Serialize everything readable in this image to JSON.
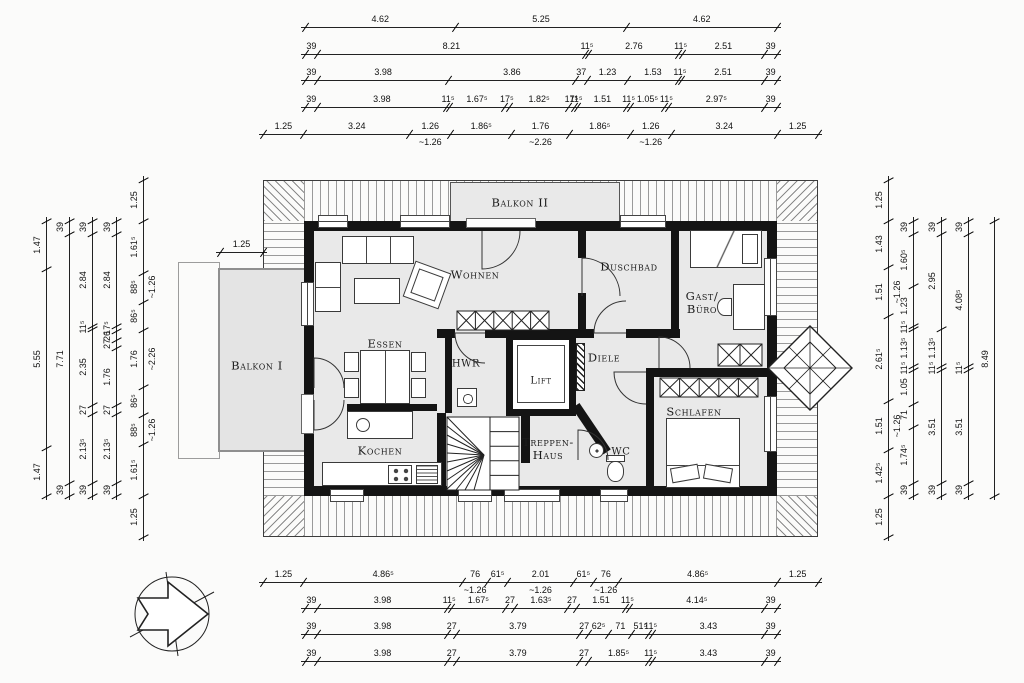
{
  "rooms": {
    "balkon2": "Balkon II",
    "wohnen": "Wohnen",
    "duschbad": "Duschbad",
    "gast_line1": "Gast/",
    "gast_line2": "Büro",
    "essen": "Essen",
    "hwr": "HWR",
    "lift": "Lift",
    "diele": "Diele",
    "balkon1": "Balkon I",
    "schlafen": "Schlafen",
    "kochen": "Kochen",
    "treppen_line1": "Treppen-",
    "treppen_line2": "Haus",
    "wc": "WC"
  },
  "colors": {
    "wall": "#141414",
    "floor": "#e9e9e9",
    "balcony": "#e4e4e4",
    "dimline": "#222222"
  },
  "dims": {
    "t1": [
      {
        "l": "4.62",
        "w": 4.62
      },
      {
        "l": "5.25",
        "w": 5.25
      },
      {
        "l": "4.62",
        "w": 4.62
      }
    ],
    "t2": [
      {
        "l": "39",
        "w": 0.39
      },
      {
        "l": "8.21",
        "w": 8.21
      },
      {
        "l": "11⁵",
        "w": 0.115
      },
      {
        "l": "2.76",
        "w": 2.76
      },
      {
        "l": "11⁵",
        "w": 0.115
      },
      {
        "l": "2.51",
        "w": 2.51
      },
      {
        "l": "39",
        "w": 0.39
      }
    ],
    "t3": [
      {
        "l": "39",
        "w": 0.39
      },
      {
        "l": "3.98",
        "w": 3.98
      },
      {
        "l": "3.86",
        "w": 3.86
      },
      {
        "l": "37",
        "w": 0.37
      },
      {
        "l": "1.23",
        "w": 1.23
      },
      {
        "l": "1.53",
        "w": 1.53
      },
      {
        "l": "11⁵",
        "w": 0.115
      },
      {
        "l": "2.51",
        "w": 2.51
      },
      {
        "l": "39",
        "w": 0.39
      }
    ],
    "t4": [
      {
        "l": "39",
        "w": 0.39
      },
      {
        "l": "3.98",
        "w": 3.98
      },
      {
        "l": "11⁵",
        "w": 0.115
      },
      {
        "l": "1.67⁵",
        "w": 1.675
      },
      {
        "l": "17⁵",
        "w": 0.175
      },
      {
        "l": "1.82⁵",
        "w": 1.825
      },
      {
        "l": "17⁵",
        "w": 0.175
      },
      {
        "l": "11⁵",
        "w": 0.115
      },
      {
        "l": "1.51",
        "w": 1.51
      },
      {
        "l": "11⁵",
        "w": 0.115
      },
      {
        "l": "1.05⁵",
        "w": 1.055
      },
      {
        "l": "11⁵",
        "w": 0.115
      },
      {
        "l": "2.97⁵",
        "w": 2.975
      },
      {
        "l": "39",
        "w": 0.39
      }
    ],
    "t5": [
      {
        "l": "1.25",
        "w": 1.25
      },
      {
        "l": "3.24",
        "w": 3.24
      },
      {
        "l": "1.26",
        "w": 1.26,
        "s": "~1.26"
      },
      {
        "l": "1.86⁵",
        "w": 1.865
      },
      {
        "l": "1.76",
        "w": 1.76,
        "s": "~2.26"
      },
      {
        "l": "1.86⁵",
        "w": 1.865
      },
      {
        "l": "1.26",
        "w": 1.26,
        "s": "~1.26"
      },
      {
        "l": "3.24",
        "w": 3.24
      },
      {
        "l": "1.25",
        "w": 1.25
      }
    ],
    "b1": [
      {
        "l": "1.25",
        "w": 1.25
      },
      {
        "l": "4.86⁵",
        "w": 4.865
      },
      {
        "l": "76",
        "w": 0.76,
        "s": "~1.26"
      },
      {
        "l": "61⁵",
        "w": 0.615
      },
      {
        "l": "2.01",
        "w": 2.01,
        "s": "~1.26"
      },
      {
        "l": "61⁵",
        "w": 0.615
      },
      {
        "l": "76",
        "w": 0.76,
        "s": "~1.26"
      },
      {
        "l": "4.86⁵",
        "w": 4.865
      },
      {
        "l": "1.25",
        "w": 1.25
      }
    ],
    "b2": [
      {
        "l": "39",
        "w": 0.39
      },
      {
        "l": "3.98",
        "w": 3.98
      },
      {
        "l": "11⁵",
        "w": 0.115
      },
      {
        "l": "1.67⁵",
        "w": 1.675
      },
      {
        "l": "27",
        "w": 0.27
      },
      {
        "l": "1.63⁵",
        "w": 1.635
      },
      {
        "l": "27",
        "w": 0.27
      },
      {
        "l": "1.51",
        "w": 1.51
      },
      {
        "l": "11⁵",
        "w": 0.115
      },
      {
        "l": "4.14⁵",
        "w": 4.145
      },
      {
        "l": "39",
        "w": 0.39
      }
    ],
    "b3": [
      {
        "l": "39",
        "w": 0.39
      },
      {
        "l": "3.98",
        "w": 3.98
      },
      {
        "l": "27",
        "w": 0.27
      },
      {
        "l": "3.79",
        "w": 3.79
      },
      {
        "l": "27",
        "w": 0.27
      },
      {
        "l": "62⁵",
        "w": 0.625
      },
      {
        "l": "71",
        "w": 0.71
      },
      {
        "l": "51⁵",
        "w": 0.515
      },
      {
        "l": "11⁵",
        "w": 0.115
      },
      {
        "l": "3.43",
        "w": 3.43
      },
      {
        "l": "39",
        "w": 0.39
      }
    ],
    "b4": [
      {
        "l": "39",
        "w": 0.39
      },
      {
        "l": "3.98",
        "w": 3.98
      },
      {
        "l": "27",
        "w": 0.27
      },
      {
        "l": "3.79",
        "w": 3.79
      },
      {
        "l": "27",
        "w": 0.27
      },
      {
        "l": "1.85⁵",
        "w": 1.855
      },
      {
        "l": "11⁵",
        "w": 0.115
      },
      {
        "l": "3.43",
        "w": 3.43
      },
      {
        "l": "39",
        "w": 0.39
      }
    ],
    "l1": [
      {
        "l": "1.47",
        "w": 1.47
      },
      {
        "l": "5.55",
        "w": 5.55
      },
      {
        "l": "1.47",
        "w": 1.47
      }
    ],
    "l2": [
      {
        "l": "39",
        "w": 0.39
      },
      {
        "l": "7.71",
        "w": 7.71
      },
      {
        "l": "39",
        "w": 0.39
      }
    ],
    "l3": [
      {
        "l": "39",
        "w": 0.39
      },
      {
        "l": "2.84",
        "w": 2.84
      },
      {
        "l": "11⁵",
        "w": 0.115
      },
      {
        "l": "2.35",
        "w": 2.35
      },
      {
        "l": "27",
        "w": 0.27
      },
      {
        "l": "2.13⁵",
        "w": 2.135
      },
      {
        "l": "39",
        "w": 0.39
      }
    ],
    "l4": [
      {
        "l": "39",
        "w": 0.39
      },
      {
        "l": "2.84",
        "w": 2.84
      },
      {
        "l": "17⁵",
        "w": 0.175
      },
      {
        "l": "26",
        "w": 0.26
      },
      {
        "l": "27",
        "w": 0.27
      },
      {
        "l": "1.76",
        "w": 1.76
      },
      {
        "l": "27",
        "w": 0.27
      },
      {
        "l": "2.13⁵",
        "w": 2.135
      },
      {
        "l": "39",
        "w": 0.39
      }
    ],
    "l5": [
      {
        "l": "1.25",
        "w": 1.25
      },
      {
        "l": "1.61⁵",
        "w": 1.615
      },
      {
        "l": "88⁵",
        "w": 0.885,
        "s": "~1.26"
      },
      {
        "l": "86⁵",
        "w": 0.865
      },
      {
        "l": "1.76",
        "w": 1.76,
        "s": "~2.26"
      },
      {
        "l": "86⁵",
        "w": 0.865
      },
      {
        "l": "88⁵",
        "w": 0.885,
        "s": "~1.26"
      },
      {
        "l": "1.61⁵",
        "w": 1.615
      },
      {
        "l": "1.25",
        "w": 1.25
      }
    ],
    "r1": [
      {
        "l": "1.25",
        "w": 1.25
      },
      {
        "l": "1.43",
        "w": 1.43
      },
      {
        "l": "1.51",
        "w": 1.51,
        "s": "~1.26"
      },
      {
        "l": "2.61⁵",
        "w": 2.615
      },
      {
        "l": "1.51",
        "w": 1.51,
        "s": "~1.26"
      },
      {
        "l": "1.42⁵",
        "w": 1.425
      },
      {
        "l": "1.25",
        "w": 1.25
      }
    ],
    "r2": [
      {
        "l": "39",
        "w": 0.39
      },
      {
        "l": "1.60⁵",
        "w": 1.605
      },
      {
        "l": "1.23",
        "w": 1.23
      },
      {
        "l": "11⁵",
        "w": 0.115
      },
      {
        "l": "1.13⁵",
        "w": 1.135
      },
      {
        "l": "11⁵",
        "w": 0.115
      },
      {
        "l": "1.05",
        "w": 1.05
      },
      {
        "l": "71",
        "w": 0.71
      },
      {
        "l": "1.74⁵",
        "w": 1.745
      },
      {
        "l": "39",
        "w": 0.39
      }
    ],
    "r3": [
      {
        "l": "39",
        "w": 0.39
      },
      {
        "l": "2.95",
        "w": 2.95
      },
      {
        "l": "1.13⁵",
        "w": 1.135
      },
      {
        "l": "11⁵",
        "w": 0.115
      },
      {
        "l": "3.51",
        "w": 3.51
      },
      {
        "l": "39",
        "w": 0.39
      }
    ],
    "r4": [
      {
        "l": "39",
        "w": 0.39
      },
      {
        "l": "4.08⁵",
        "w": 4.085
      },
      {
        "l": "11⁵",
        "w": 0.115
      },
      {
        "l": "3.51",
        "w": 3.51
      },
      {
        "l": "39",
        "w": 0.39
      }
    ],
    "r5": [
      {
        "l": "8.49",
        "w": 8.49
      }
    ],
    "bk": [
      {
        "l": "1.25",
        "w": 1.25
      }
    ]
  }
}
